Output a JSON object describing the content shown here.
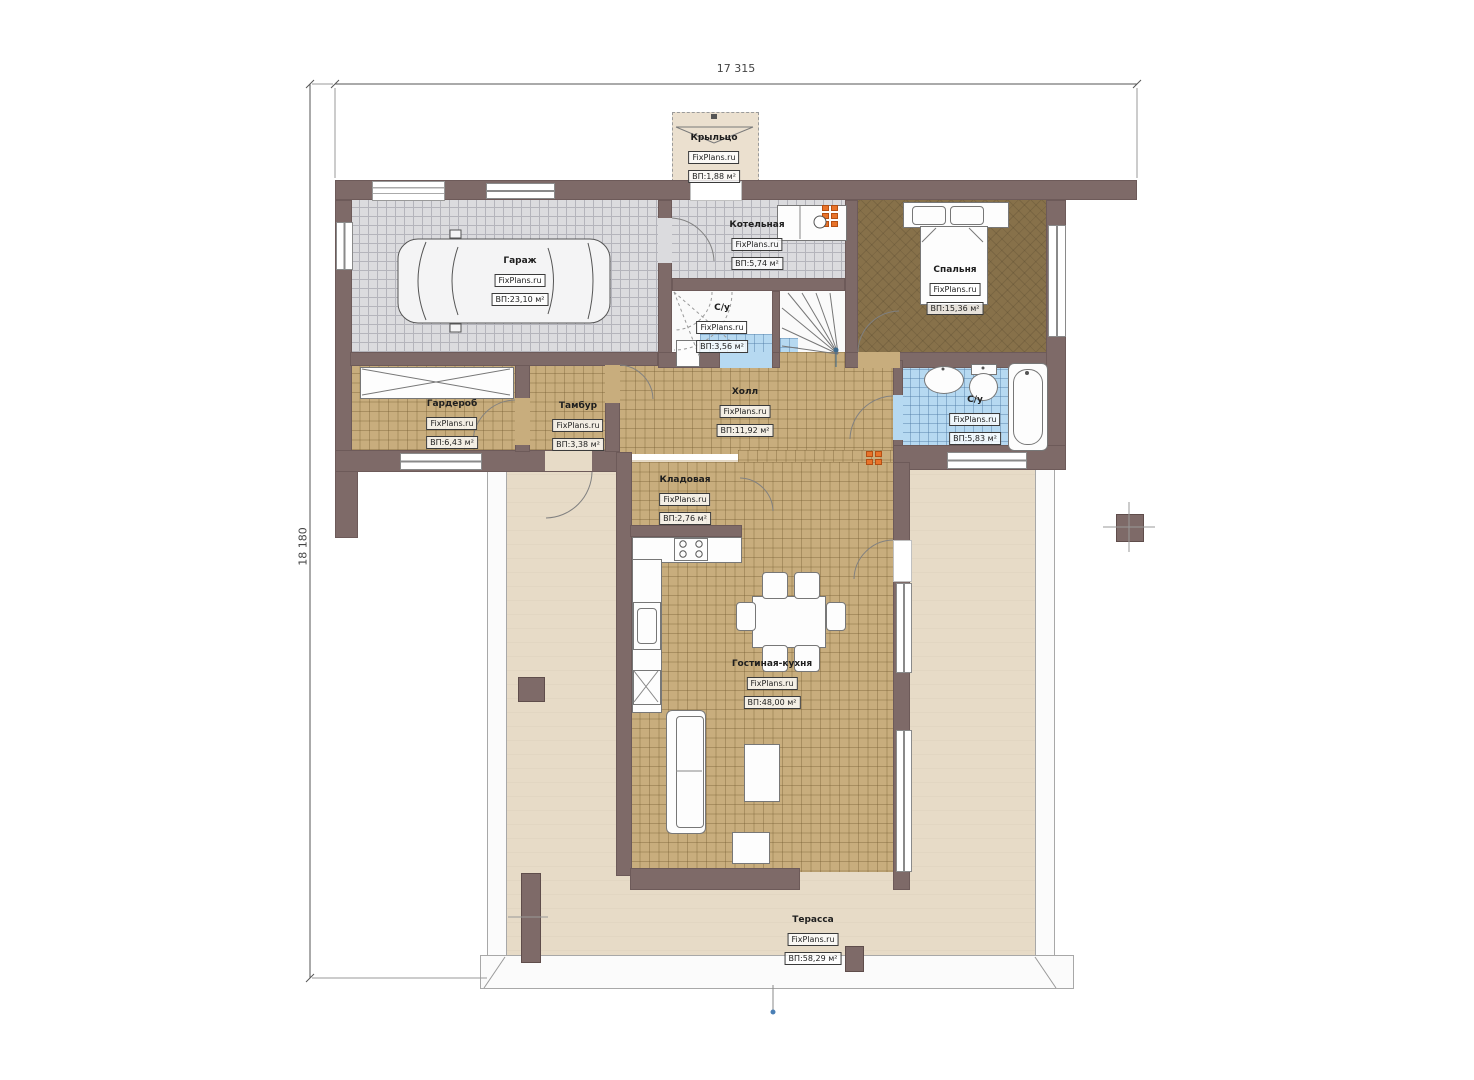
{
  "plan_title": "План 1 этажа",
  "brand": "FixPlans.ru",
  "dimensions": {
    "width_total": "17 315",
    "height_total": "18 180"
  },
  "rooms": {
    "porch": {
      "name": "Крыльцо",
      "brand": "FixPlans.ru",
      "area": "ВП:1,88 м²"
    },
    "garage": {
      "name": "Гараж",
      "brand": "FixPlans.ru",
      "area": "ВП:23,10 м²"
    },
    "boiler": {
      "name": "Котельная",
      "brand": "FixPlans.ru",
      "area": "ВП:5,74 м²"
    },
    "bedroom": {
      "name": "Спальня",
      "brand": "FixPlans.ru",
      "area": "ВП:15,36 м²"
    },
    "bath_small": {
      "name": "С/у",
      "brand": "FixPlans.ru",
      "area": "ВП:3,56 м²"
    },
    "wardrobe": {
      "name": "Гардероб",
      "brand": "FixPlans.ru",
      "area": "ВП:6,43 м²"
    },
    "vestibule": {
      "name": "Тамбур",
      "brand": "FixPlans.ru",
      "area": "ВП:3,38 м²"
    },
    "hall": {
      "name": "Холл",
      "brand": "FixPlans.ru",
      "area": "ВП:11,92 м²"
    },
    "bath_main": {
      "name": "С/у",
      "brand": "FixPlans.ru",
      "area": "ВП:5,83 м²"
    },
    "pantry": {
      "name": "Кладовая",
      "brand": "FixPlans.ru",
      "area": "ВП:2,76 м²"
    },
    "living_kitchen": {
      "name": "Гостиная-кухня",
      "brand": "FixPlans.ru",
      "area": "ВП:48,00 м²"
    },
    "terrace": {
      "name": "Терасса",
      "brand": "FixPlans.ru",
      "area": "ВП:58,29 м²"
    }
  },
  "colors": {
    "wall": "#7e6a68",
    "floor_tan": "#c8ad7d",
    "floor_gray": "#dbdbde",
    "floor_bedroom": "#87714a",
    "floor_blue": "#b6d9f1",
    "terrace": "#e7dbc7",
    "radiator": "#e8732a",
    "marker_blue": "#4a7fb5"
  }
}
